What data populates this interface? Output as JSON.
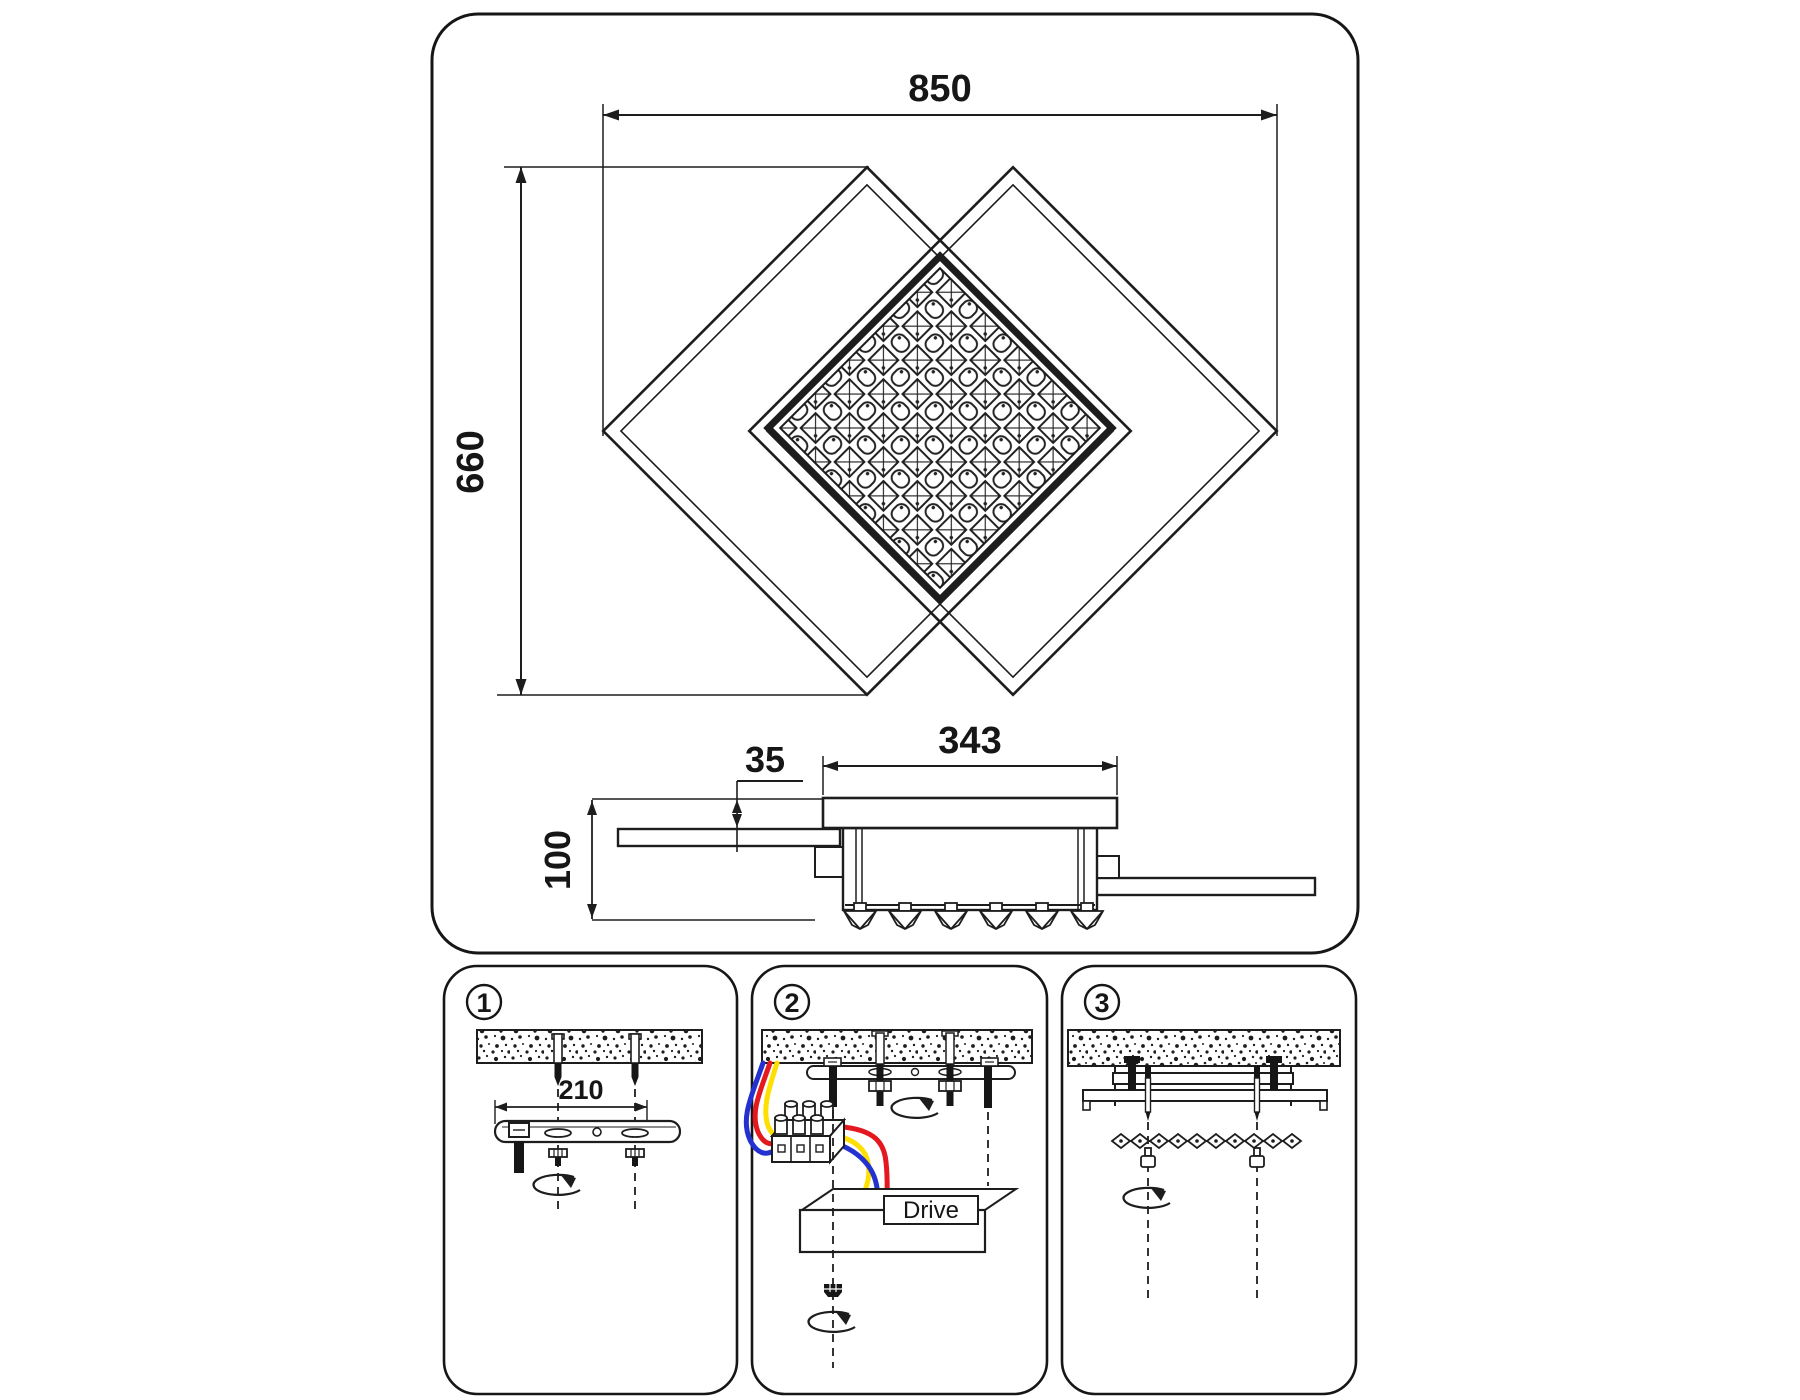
{
  "page": {
    "background": "#ffffff",
    "line_color": "#1d1d1d"
  },
  "main_drawing": {
    "top_view": {
      "dim_overall_width": "850",
      "dim_frame_diagonal": "660"
    },
    "side_view": {
      "dim_center_width": "343",
      "dim_frame_offset": "35",
      "dim_height": "100"
    }
  },
  "installation_steps": {
    "step_1": {
      "badge": "1",
      "dim_bracket_spacing": "210"
    },
    "step_2": {
      "badge": "2",
      "driver_label": "Drive"
    },
    "step_3": {
      "badge": "3"
    }
  },
  "wires": {
    "blue": "#2431d1",
    "red": "#e41920",
    "yellow": "#ffdf00"
  }
}
